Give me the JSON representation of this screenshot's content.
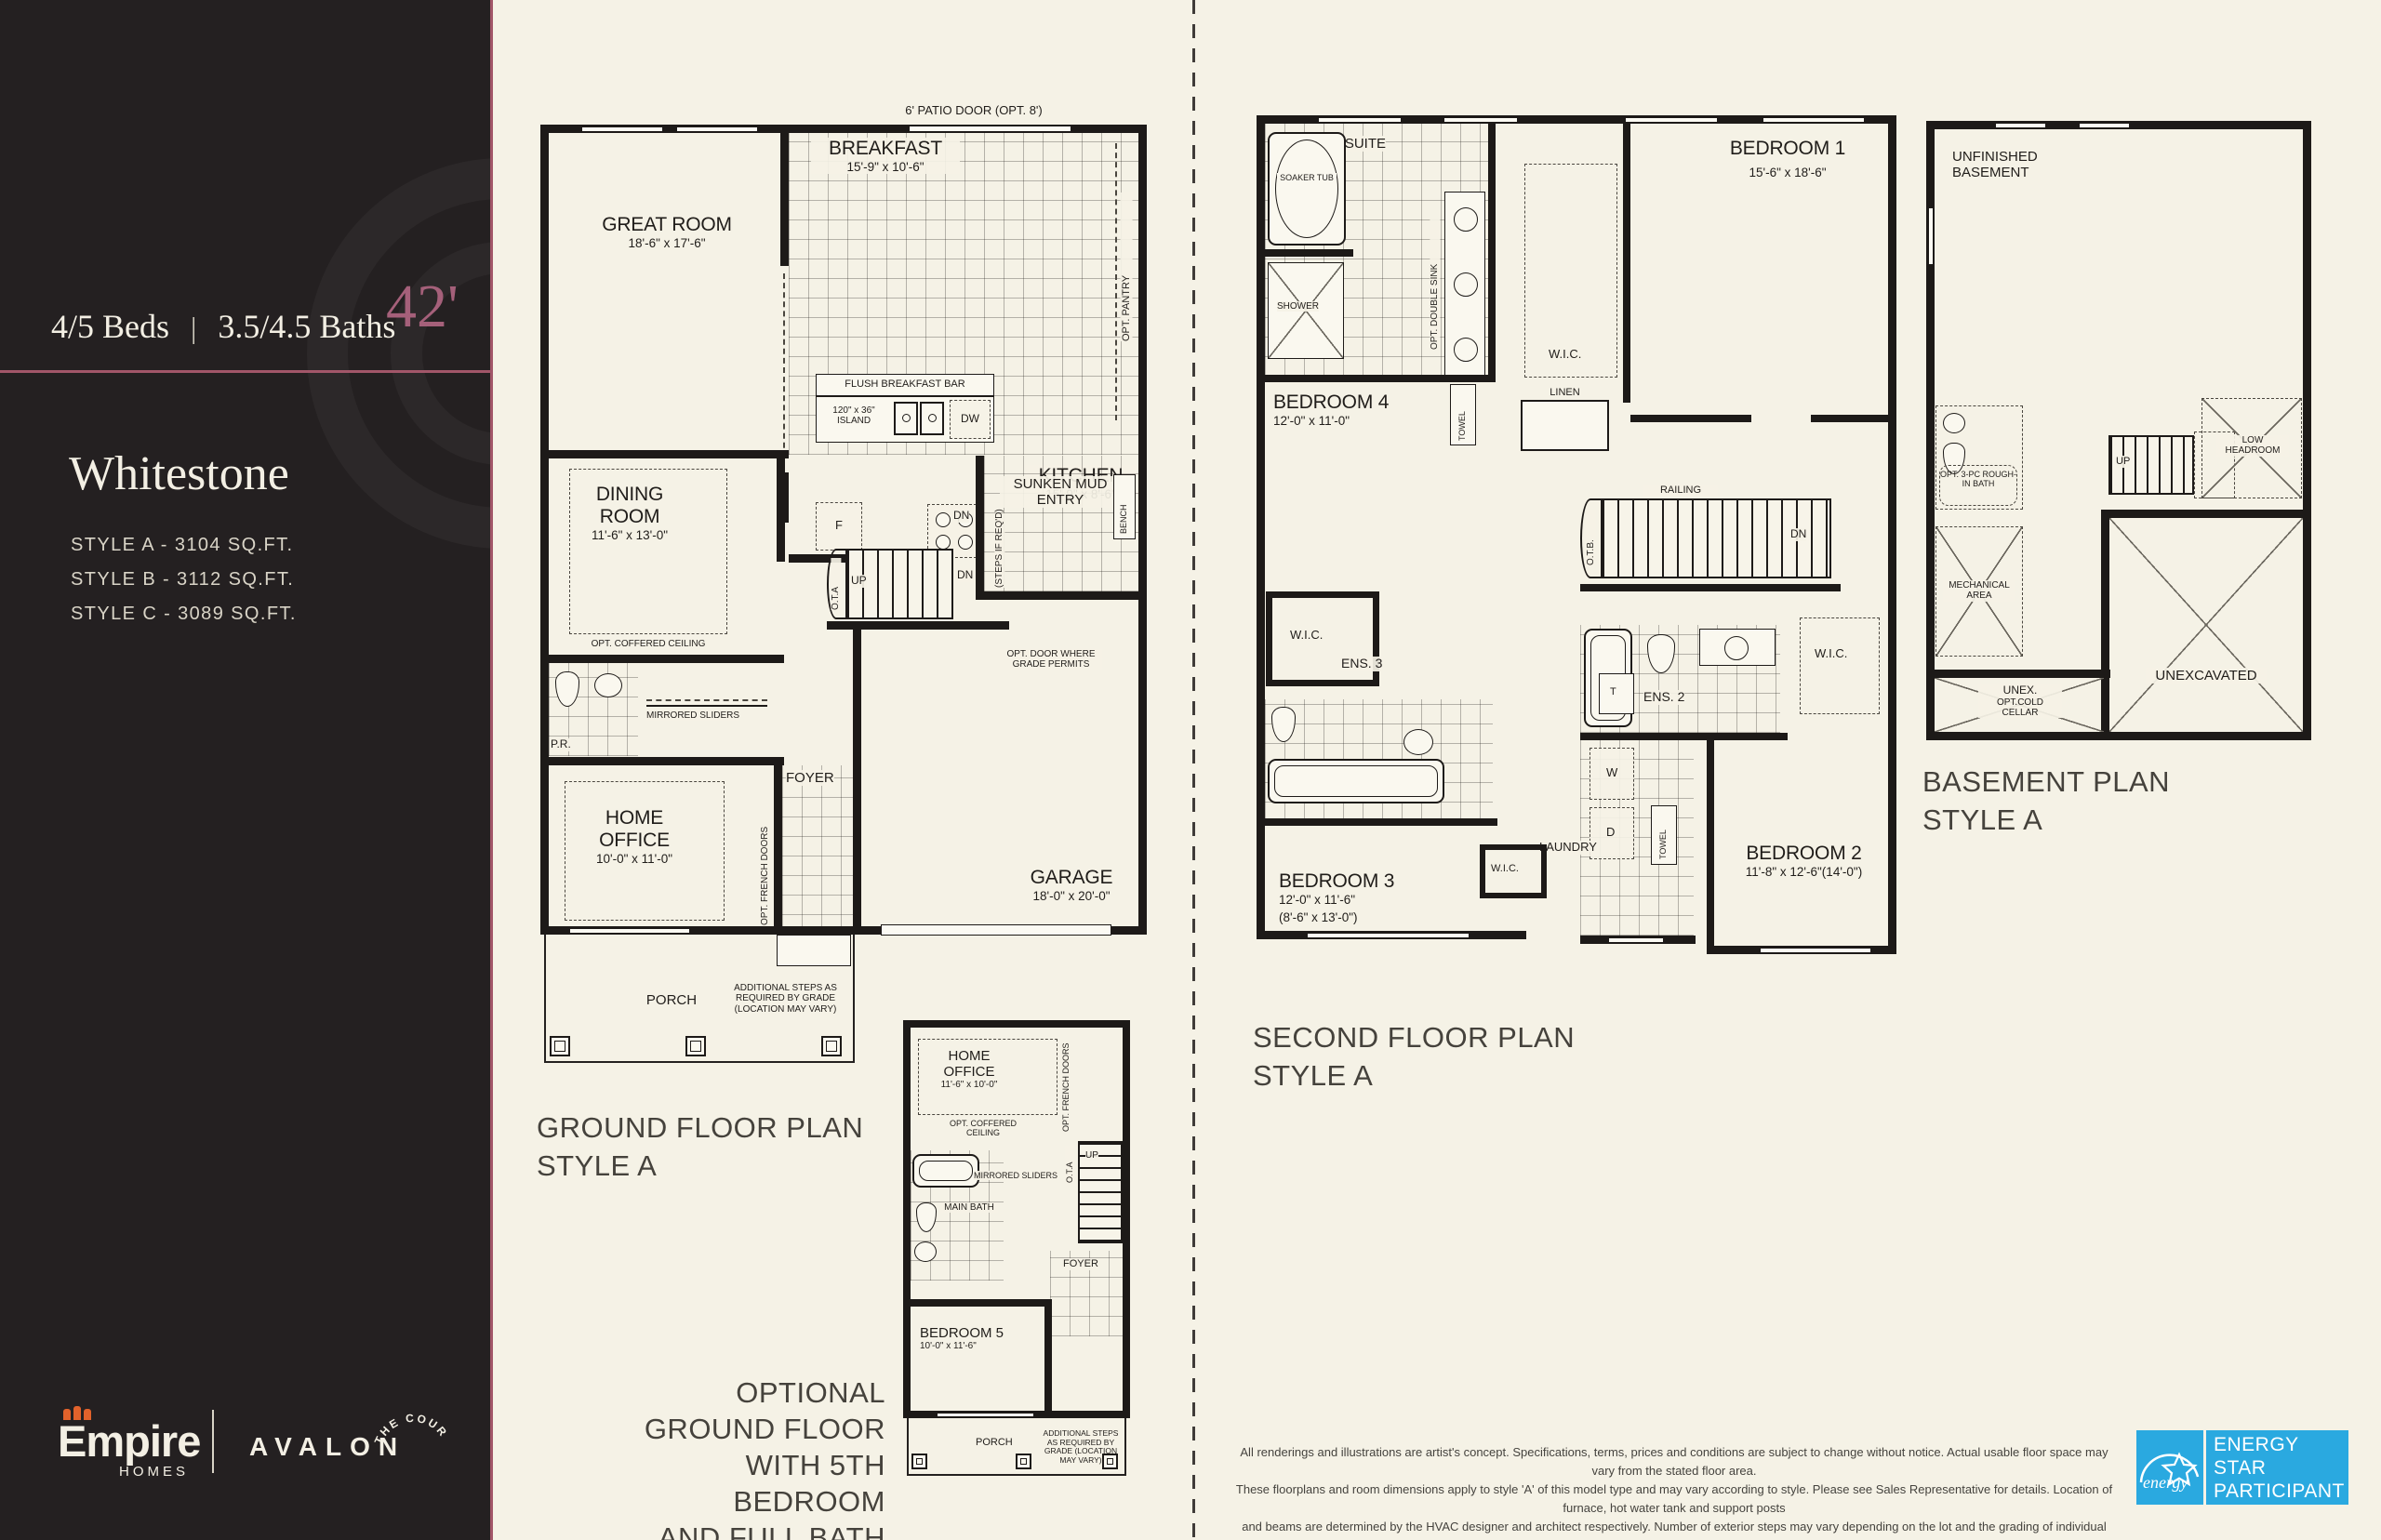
{
  "sidebar": {
    "beds": "4/5 Beds",
    "separator": "|",
    "baths": "3.5/4.5 Baths",
    "width_badge": "42'",
    "model_name": "Whitestone",
    "styles": [
      "STYLE A - 3104 SQ.FT.",
      "STYLE B - 3112 SQ.FT.",
      "STYLE C - 3089 SQ.FT."
    ],
    "brand": {
      "empire": "Empire",
      "homes": "HOMES",
      "avalon": "AVALON",
      "court": "THE COURT"
    }
  },
  "ground": {
    "title1": "GROUND FLOOR PLAN",
    "title2": "STYLE A",
    "patio_door": "6' PATIO DOOR (OPT. 8')",
    "great_room": {
      "name": "GREAT ROOM",
      "dims": "18'-6\" x 17'-6\""
    },
    "breakfast": {
      "name": "BREAKFAST",
      "dims": "15'-9\" x 10'-6\""
    },
    "opt_pantry": "OPT. PANTRY",
    "flush_bar": "FLUSH BREAKFAST BAR",
    "island": "120\" x 36\" ISLAND",
    "dw": "DW",
    "kitchen": {
      "name": "KITCHEN",
      "dims": "15'-9\" x 8'-6\""
    },
    "fridge": "F",
    "mud_entry": "SUNKEN MUD ENTRY",
    "bench": "BENCH",
    "dn": "DN",
    "steps_if_reqd": "(STEPS IF REQ'D)",
    "up": "UP",
    "ota": "O.T.A",
    "opt_door": "OPT. DOOR WHERE GRADE PERMITS",
    "dining": {
      "name": "DINING ROOM",
      "dims": "11'-6\" x 13'-0\"",
      "coffered": "OPT. COFFERED CEILING"
    },
    "pr": "P.R.",
    "mirrored_sliders": "MIRRORED SLIDERS",
    "home_office": {
      "name": "HOME OFFICE",
      "dims": "10'-0\" x 11'-0\"",
      "coffered": "OPT. COFFERED CEILING"
    },
    "opt_french_doors": "OPT. FRENCH DOORS",
    "foyer": "FOYER",
    "garage": {
      "name": "GARAGE",
      "dims": "18'-0\" x 20'-0\""
    },
    "porch": "PORCH",
    "additional_steps": "ADDITIONAL STEPS AS REQUIRED BY GRADE (LOCATION MAY VARY)"
  },
  "optional": {
    "caption": [
      "OPTIONAL",
      "GROUND FLOOR",
      "WITH 5TH BEDROOM",
      "AND FULL BATH"
    ],
    "home_office": {
      "name": "HOME OFFICE",
      "dims": "11'-6\" x 10'-0\"",
      "coffered": "OPT. COFFERED CEILING"
    },
    "opt_french_doors": "OPT. FRENCH DOORS",
    "mirrored_sliders": "MIRRORED SLIDERS",
    "main_bath": "MAIN BATH",
    "foyer": "FOYER",
    "ota": "O.T.A",
    "up": "UP",
    "bedroom5": {
      "name": "BEDROOM 5",
      "dims": "10'-0\" x 11'-6\""
    },
    "porch": "PORCH",
    "additional_steps": "ADDITIONAL STEPS AS REQUIRED BY GRADE (LOCATION MAY VARY)"
  },
  "second": {
    "title1": "SECOND FLOOR PLAN",
    "title2": "STYLE A",
    "ensuite": "ENSUITE",
    "soaker_tub": "SOAKER TUB",
    "shower": "SHOWER",
    "opt_double_sink": "OPT. DOUBLE SINK",
    "towel": "TOWEL",
    "bedroom1": {
      "name": "BEDROOM 1",
      "dims": "15'-6\" x 18'-6\""
    },
    "wic": "W.I.C.",
    "linen": "LINEN",
    "bedroom4": {
      "name": "BEDROOM 4",
      "dims": "12'-0\" x 11'-0\""
    },
    "railing": "RAILING",
    "otb": "O.T.B.",
    "dn": "DN",
    "ens3": "ENS. 3",
    "ens2": "ENS. 2",
    "t": "T",
    "w": "W",
    "d": "D",
    "laundry": "LAUNDRY",
    "bedroom2": {
      "name": "BEDROOM 2",
      "dims": "11'-8\" x 12'-6\"(14'-0\")"
    },
    "bedroom3": {
      "name": "BEDROOM 3",
      "dims": "12'-0\" x 11'-6\"",
      "dims2": "(8'-6\" x 13'-0\")"
    }
  },
  "basement": {
    "title1": "BASEMENT PLAN",
    "title2": "STYLE A",
    "unfinished": "UNFINISHED BASEMENT",
    "opt_bath": "OPT. 3-PC ROUGH-IN BATH",
    "mechanical": "MECHANICAL AREA",
    "up": "UP",
    "low_headroom": "LOW HEADROOM",
    "unexcavated": "UNEXCAVATED",
    "cold_cellar1": "UNEX.",
    "cold_cellar2": "OPT.COLD",
    "cold_cellar3": "CELLAR"
  },
  "footer": {
    "disclaimer": [
      "All renderings and illustrations are artist's concept. Specifications, terms, prices and conditions are subject to change without notice. Actual usable floor space may vary from the stated floor area.",
      "These floorplans and room dimensions apply to style 'A' of this model type and may vary according to style. Please see Sales Representative for details. Location of furnace, hot water tank and support posts",
      "and beams are determined by the HVAC designer and architect respectively. Number of exterior steps may vary depending on the lot and the grading of individual home sites. July 2025. E.&O.E. 42-26"
    ]
  },
  "energy": {
    "script": "energy",
    "l1": "ENERGY",
    "l2": "STAR",
    "l3": "PARTICIPANT",
    "blue": "#2aa9e0"
  }
}
